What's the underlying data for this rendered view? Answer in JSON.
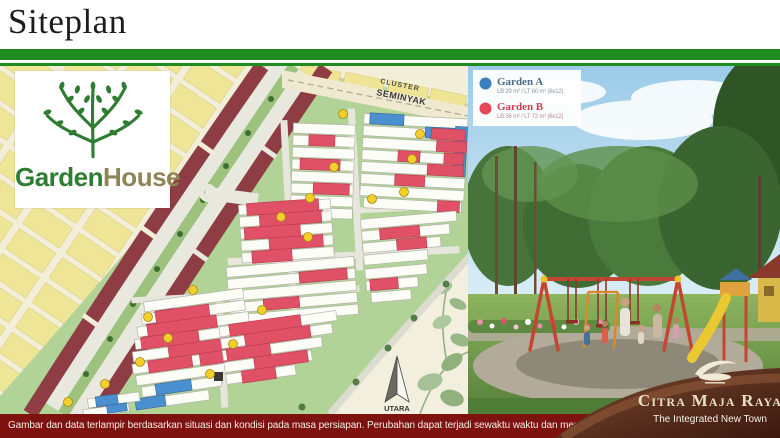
{
  "slide": {
    "title": "Siteplan"
  },
  "logo": {
    "garden": "Garden",
    "house": "House"
  },
  "map": {
    "cluster_label": {
      "line1": "CLUSTER",
      "line2": "SEMINYAK"
    },
    "compass_label": "UTARA"
  },
  "legend": {
    "items": [
      {
        "name": "Garden A",
        "spec": "LB 29 m² / LT 60 m² (6x12)",
        "color": "#3b7fbf"
      },
      {
        "name": "Garden B",
        "spec": "LB 36 m² / LT 72 m² (6x12)",
        "color": "#e4475a"
      }
    ]
  },
  "brand": {
    "name": "Citra Maja Raya",
    "tagline": "The Integrated New Town"
  },
  "footer": {
    "disclaimer": "Gambar dan data terlampir berdasarkan situasi dan kondisi pada masa persiapan. Perubahan dapat terjadi sewaktu waktu dan merupakan hak penuh developer"
  },
  "colors": {
    "header_green": "#1f8c1f",
    "footer_red": "#7e120e",
    "garden_a_blue": "#3b7fbf",
    "garden_b_red": "#e4475a",
    "logo_green": "#2e7d32",
    "logo_olive": "#8f8455"
  }
}
